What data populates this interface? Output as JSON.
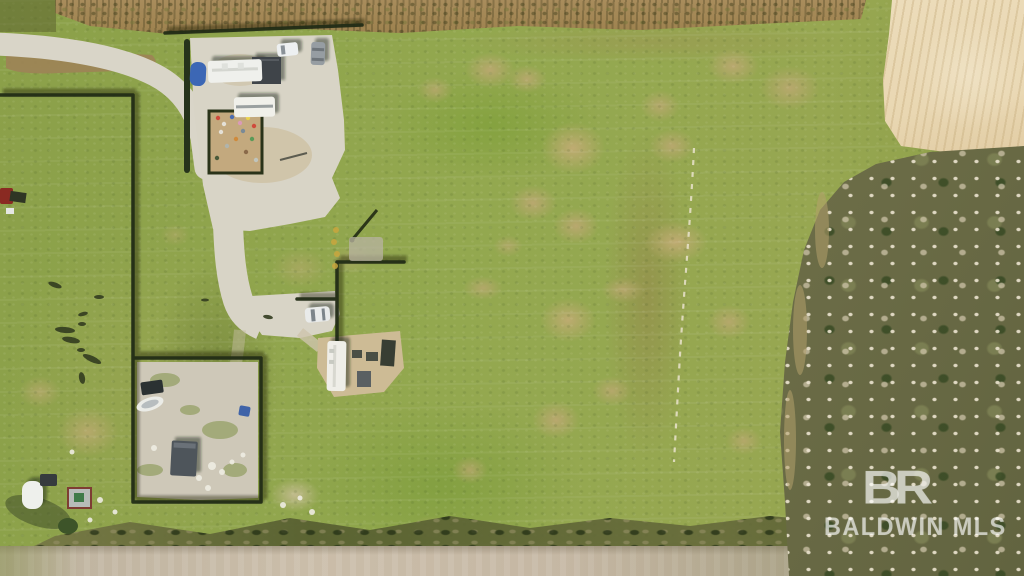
{
  "watermark": {
    "logo": "BR",
    "org": "BALDWIN MLS"
  },
  "scene": {
    "alt": "Aerial drone photograph of a rural property: green pastures with worn tan patches, a curving gravel drive leading to RV campers and parking pads, dark fence lines, a fenced gravel yard with a boat and utility trailer, small sheds and a white tank, a plowed tan field at upper right, bare winter woodland along the right side, a dry brush strip at top, a hedge row and dirt road along the bottom."
  },
  "features": [
    "gravel-entrance-road",
    "parking-pad",
    "rv-camper",
    "rv-camper-2",
    "camper-trailer-center",
    "garden-plot",
    "fence-lines",
    "boat",
    "yard-utility-trailer",
    "storage-shed",
    "white-tank",
    "pasture",
    "plowed-field",
    "woodland",
    "hedge-row",
    "dirt-road",
    "dashed-track",
    "mls-watermark"
  ],
  "palette": {
    "grass_green": "#8fa44b",
    "patch_tan": "#bfa874",
    "gravel": "#d8d4c6",
    "dirt_pad": "#cdbb95",
    "plowed_tan": "#e9d7b2",
    "brush_brown": "#a2885a",
    "woodland_olive": "#6e6c45",
    "canopy_light": "#d9cfb8",
    "fence_dark": "#222c16",
    "hedge_dark": "#4c5a2c",
    "road_tan": "#c3b5a1",
    "rv_white": "#efefea",
    "tank_blue": "#3c67b5",
    "car_gray": "#969da2",
    "shed_red": "#7e3d33",
    "watermark_white": "rgba(255,255,255,0.55)"
  }
}
